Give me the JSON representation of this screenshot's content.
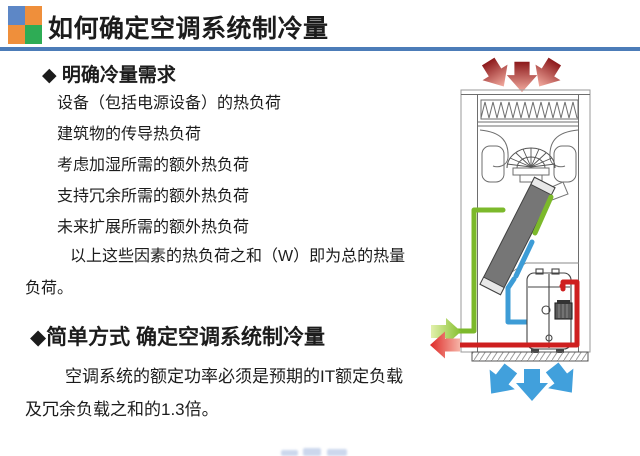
{
  "header": {
    "title": "如何确定空调系统制冷量",
    "underline_color": "#4C7CB8",
    "logo_colors": {
      "top_left": "#5D87C6",
      "top_right": "#EF8F3B",
      "bottom_left": "#EF8F3B",
      "bottom_right": "#2EAC55"
    }
  },
  "content": {
    "section1": {
      "heading": "◆ 明确冷量需求",
      "items": [
        "设备（包括电源设备）的热负荷",
        "建筑物的传导热负荷",
        "考虑加湿所需的额外热负荷",
        "支持冗余所需的额外热负荷",
        "未来扩展所需的额外热负荷",
        "以上这些因素的热负荷之和（W）即为总的热量负荷。"
      ]
    },
    "section2": {
      "heading": "◆简单方式 确定空调系统制冷量",
      "body": "空调系统的额定功率必须是预期的IT额定负载及冗余负载之和的1.3倍。"
    }
  },
  "diagram": {
    "colors": {
      "hot_air_arrows_dark": "#8C191B",
      "hot_air_arrows_light": "#F3ACA0",
      "cold_air_arrows": "#41A0DC",
      "supply_line_green": "#7CB92B",
      "hot_gas_line_red": "#CE1F1F",
      "suction_line_blue": "#3D9CD6",
      "coil_fill": "#767676",
      "cabinet_stroke": "#6e6e6e"
    }
  }
}
